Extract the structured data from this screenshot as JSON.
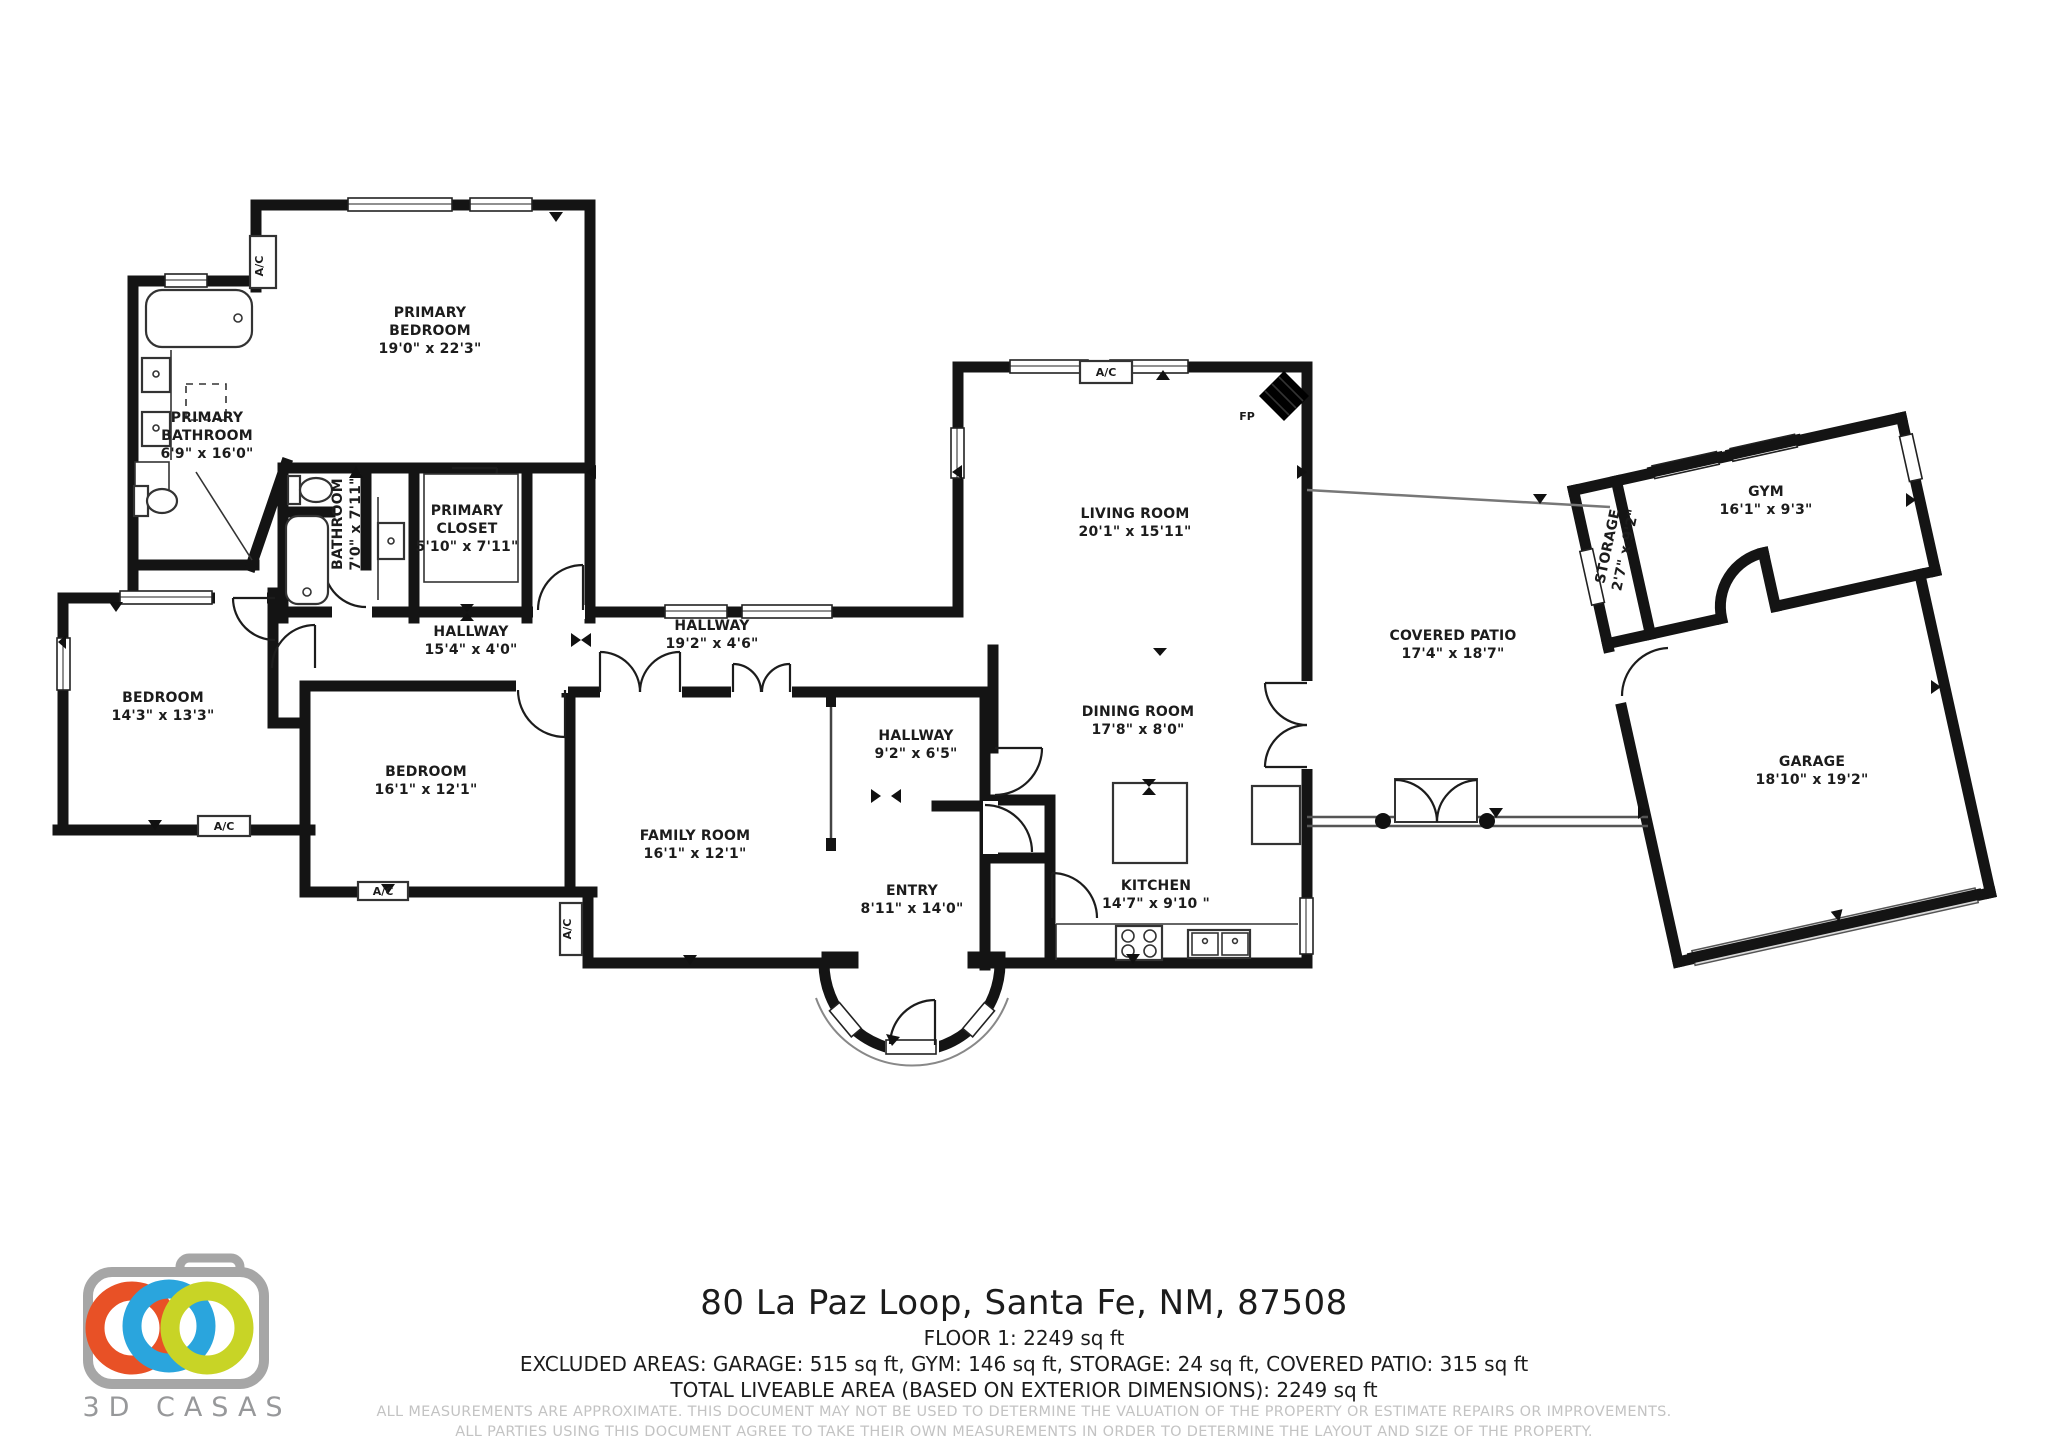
{
  "document": {
    "address": "80 La Paz Loop, Santa Fe, NM, 87508",
    "floor_line": "FLOOR 1: 2249 sq ft",
    "excluded_line": "EXCLUDED AREAS: GARAGE: 515 sq ft, GYM: 146 sq ft, STORAGE: 24 sq ft, COVERED PATIO: 315 sq ft",
    "total_line": "TOTAL LIVEABLE AREA (BASED ON EXTERIOR DIMENSIONS): 2249 sq ft",
    "disclaimer_line1": "ALL MEASUREMENTS ARE APPROXIMATE. THIS DOCUMENT MAY NOT BE USED TO DETERMINE THE VALUATION OF THE PROPERTY OR ESTIMATE REPAIRS OR IMPROVEMENTS.",
    "disclaimer_line2": "ALL PARTIES USING THIS DOCUMENT AGREE TO TAKE THEIR OWN MEASUREMENTS IN ORDER TO DETERMINE THE LAYOUT AND SIZE OF THE PROPERTY."
  },
  "brand": {
    "name": "3D CASAS",
    "logo_colors": {
      "camera": "#a6a6a6",
      "ring_orange": "#e85126",
      "ring_blue": "#2aa5dd",
      "ring_green": "#c8d426"
    }
  },
  "floorplan": {
    "wall_color": "#141414",
    "rooms": [
      {
        "id": "primary-bedroom",
        "lines": [
          "PRIMARY",
          "BEDROOM"
        ],
        "dims": "19'0\" x 22'3\"",
        "x": 430,
        "y": 330,
        "rot": 0
      },
      {
        "id": "primary-bathroom",
        "lines": [
          "PRIMARY",
          "BATHROOM"
        ],
        "dims": "6'9\" x 16'0\"",
        "x": 207,
        "y": 435,
        "rot": 0
      },
      {
        "id": "bathroom",
        "lines": [
          "BATHROOM"
        ],
        "dims": "7'0\" x 7'11\"",
        "x": 346,
        "y": 524,
        "rot": -90
      },
      {
        "id": "primary-closet",
        "lines": [
          "PRIMARY",
          "CLOSET"
        ],
        "dims": "5'10\" x 7'11\"",
        "x": 467,
        "y": 528,
        "rot": 0
      },
      {
        "id": "hallway-1",
        "lines": [
          "HALLWAY"
        ],
        "dims": "15'4\" x 4'0\"",
        "x": 471,
        "y": 640,
        "rot": 0
      },
      {
        "id": "hallway-2",
        "lines": [
          "HALLWAY"
        ],
        "dims": "19'2\" x 4'6\"",
        "x": 712,
        "y": 634,
        "rot": 0
      },
      {
        "id": "hallway-3",
        "lines": [
          "HALLWAY"
        ],
        "dims": "9'2\" x 6'5\"",
        "x": 916,
        "y": 744,
        "rot": 0
      },
      {
        "id": "bedroom-1",
        "lines": [
          "BEDROOM"
        ],
        "dims": "14'3\" x 13'3\"",
        "x": 163,
        "y": 706,
        "rot": 0
      },
      {
        "id": "bedroom-2",
        "lines": [
          "BEDROOM"
        ],
        "dims": "16'1\" x 12'1\"",
        "x": 426,
        "y": 780,
        "rot": 0
      },
      {
        "id": "family-room",
        "lines": [
          "FAMILY ROOM"
        ],
        "dims": "16'1\" x 12'1\"",
        "x": 695,
        "y": 844,
        "rot": 0
      },
      {
        "id": "entry",
        "lines": [
          "ENTRY"
        ],
        "dims": "8'11\" x 14'0\"",
        "x": 912,
        "y": 899,
        "rot": 0
      },
      {
        "id": "living-room",
        "lines": [
          "LIVING ROOM"
        ],
        "dims": "20'1\" x 15'11\"",
        "x": 1135,
        "y": 522,
        "rot": 0
      },
      {
        "id": "dining-room",
        "lines": [
          "DINING ROOM"
        ],
        "dims": "17'8\" x 8'0\"",
        "x": 1138,
        "y": 720,
        "rot": 0
      },
      {
        "id": "kitchen",
        "lines": [
          "KITCHEN"
        ],
        "dims": "14'7\" x 9'10 \"",
        "x": 1156,
        "y": 894,
        "rot": 0
      },
      {
        "id": "covered-patio",
        "lines": [
          "COVERED PATIO"
        ],
        "dims": "17'4\" x 18'7\"",
        "x": 1453,
        "y": 644,
        "rot": 0
      },
      {
        "id": "storage",
        "lines": [
          "STORAGE"
        ],
        "dims": "2'7\" x 9'2\"",
        "x": 1616,
        "y": 548,
        "rot": -78
      },
      {
        "id": "gym",
        "lines": [
          "GYM"
        ],
        "dims": "16'1\" x 9'3\"",
        "x": 1766,
        "y": 500,
        "rot": 0
      },
      {
        "id": "garage",
        "lines": [
          "GARAGE"
        ],
        "dims": "18'10\" x 19'2\"",
        "x": 1812,
        "y": 770,
        "rot": 0
      }
    ],
    "unit_labels": [
      {
        "id": "ac-primary-bedroom",
        "text": "A/C",
        "x": 263,
        "y": 266,
        "rot": -90
      },
      {
        "id": "ac-living-room",
        "text": "A/C",
        "x": 1106,
        "y": 376,
        "rot": 0
      },
      {
        "id": "ac-bedroom-1",
        "text": "A/C",
        "x": 224,
        "y": 830,
        "rot": 0
      },
      {
        "id": "ac-bedroom-2",
        "text": "A/C",
        "x": 383,
        "y": 895,
        "rot": 0
      },
      {
        "id": "ac-family-room",
        "text": "A/C",
        "x": 571,
        "y": 929,
        "rot": -90
      },
      {
        "id": "fireplace",
        "text": "FP",
        "x": 1247,
        "y": 420,
        "rot": 0
      }
    ]
  }
}
